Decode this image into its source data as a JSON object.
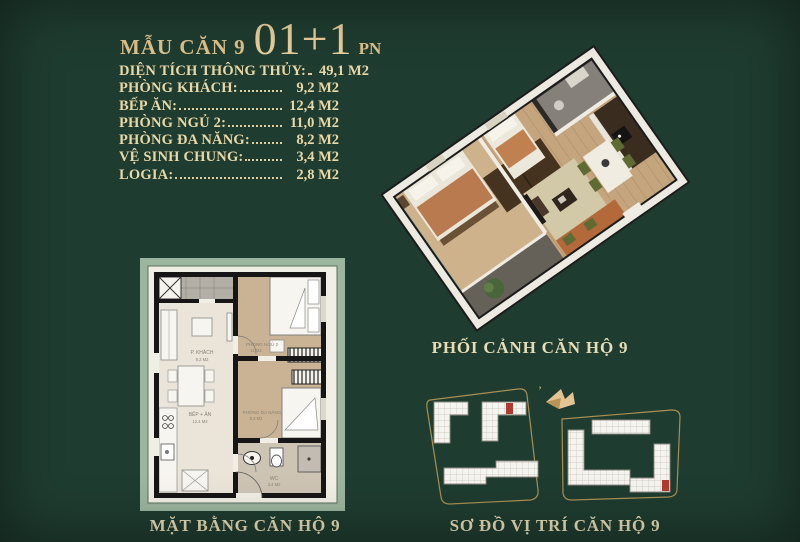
{
  "page": {
    "background": "#1f3c30",
    "gold": "#dfc189",
    "cream": "#e9d8a6"
  },
  "header": {
    "prefix": "MẪU CĂN 9",
    "big": "01+1",
    "suffix": "PN"
  },
  "specs": {
    "rows": [
      {
        "label": "DIỆN TÍCH THÔNG THỦY:",
        "value": "49,1 M2"
      },
      {
        "label": "PHÒNG KHÁCH:",
        "value": "9,2 M2"
      },
      {
        "label": "BẾP ĂN:",
        "value": "12,4 M2"
      },
      {
        "label": "PHÒNG NGỦ 2:",
        "value": "11,0 M2"
      },
      {
        "label": "PHÒNG ĐA NĂNG:",
        "value": "8,2 M2"
      },
      {
        "label": "VỆ SINH CHUNG:",
        "value": "3,4 M2"
      },
      {
        "label": "LOGIA:",
        "value": "2,8 M2"
      }
    ]
  },
  "perspective": {
    "caption": "PHỐI CẢNH CĂN HỘ 9"
  },
  "floorplan": {
    "caption": "MẶT BẰNG CĂN HỘ 9",
    "rooms": [
      {
        "name": "P. KHÁCH",
        "area": "9.2 M2"
      },
      {
        "name": "BẾP + ĂN",
        "area": "12.4 M2"
      },
      {
        "name": "PHÒNG NGỦ 2",
        "area": "11 M2"
      },
      {
        "name": "PHÒNG ĐA NĂNG",
        "area": "8.2 M2"
      },
      {
        "name": "WC",
        "area": "3.4 M2"
      }
    ]
  },
  "siteplan": {
    "caption": "SƠ ĐỒ VỊ TRÍ CĂN HỘ 9",
    "outline_color": "#a98f52",
    "highlight_color": "#b03a30",
    "logo": "brand-bird"
  }
}
